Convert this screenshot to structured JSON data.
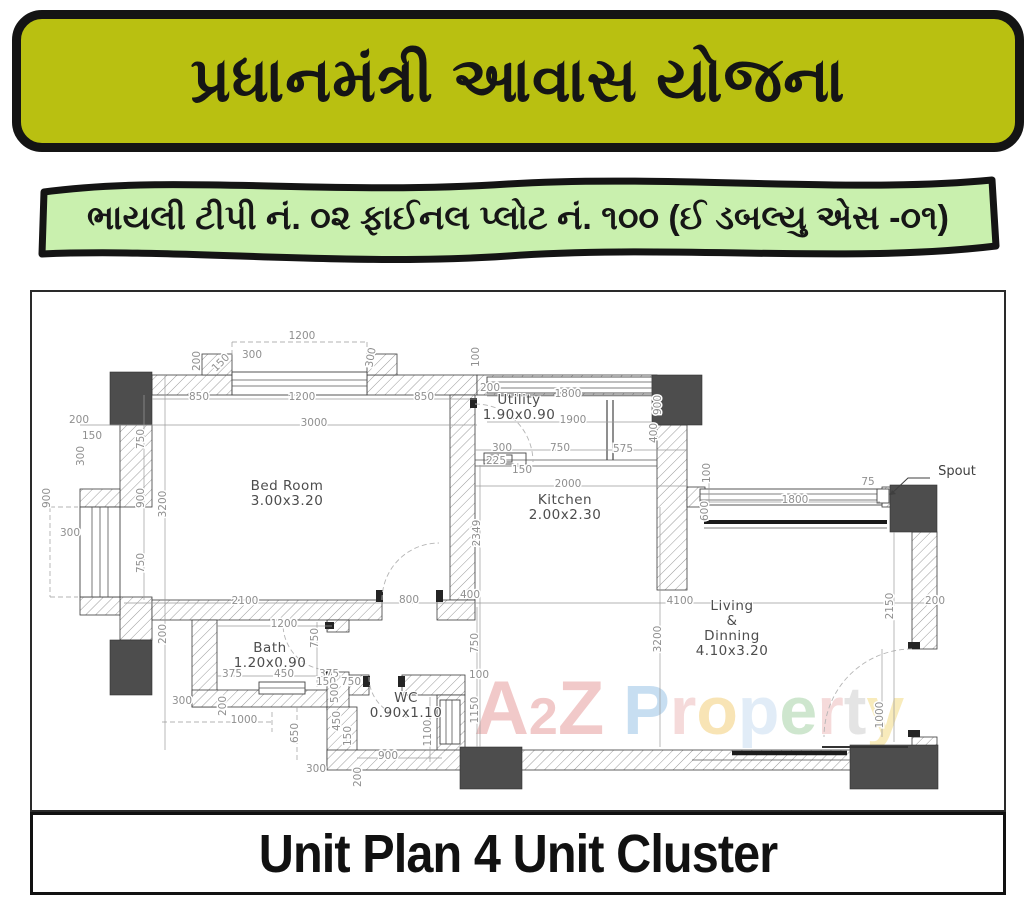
{
  "header": {
    "title": "પ્રધાનમંત્રી આવાસ યોજના"
  },
  "subheader": {
    "text": "ભાયલી ટીપી નં. ૦૨ ફાઈનલ પ્લોટ નં. ૧૦૦ (ઈ ડબલ્યુ એસ -૦૧)"
  },
  "footer": {
    "title": "Unit Plan 4 Unit Cluster"
  },
  "colors": {
    "banner1_bg": "#b9c011",
    "banner1_border": "#141414",
    "banner2_bg": "#c9f0ae",
    "ink": "#111111",
    "dim_text": "#8f8f8f",
    "wall_stroke": "#3a3a3a",
    "column_fill": "#4d4d4d"
  },
  "watermark": {
    "text": "A2Z Property",
    "letters": [
      {
        "ch": "A",
        "color": "#e07f7f",
        "size": 76
      },
      {
        "ch": "2",
        "color": "#e07f7f",
        "size": 52
      },
      {
        "ch": "Z",
        "color": "#e07f7f",
        "size": 76
      },
      {
        "ch": " ",
        "color": "#ffffff",
        "size": 68
      },
      {
        "ch": "P",
        "color": "#7bb3e0",
        "size": 70
      },
      {
        "ch": "r",
        "color": "#e8a8a8",
        "size": 68
      },
      {
        "ch": "o",
        "color": "#f0c050",
        "size": 68
      },
      {
        "ch": "p",
        "color": "#b8d4ee",
        "size": 68
      },
      {
        "ch": "e",
        "color": "#8cc68c",
        "size": 68
      },
      {
        "ch": "r",
        "color": "#e8a8a8",
        "size": 68
      },
      {
        "ch": "t",
        "color": "#c0c0c0",
        "size": 68
      },
      {
        "ch": "y",
        "color": "#f0d060",
        "size": 68
      }
    ]
  },
  "plan": {
    "annotations": {
      "spout": {
        "text": "Spout"
      }
    },
    "rooms": [
      {
        "x": 255,
        "y": 198,
        "lines": [
          "Bed Room",
          "3.00x3.20"
        ]
      },
      {
        "x": 487,
        "y": 112,
        "lines": [
          "Utility",
          "1.90x0.90"
        ]
      },
      {
        "x": 533,
        "y": 212,
        "lines": [
          "Kitchen",
          "2.00x2.30"
        ]
      },
      {
        "x": 238,
        "y": 360,
        "lines": [
          "Bath",
          "1.20x0.90"
        ]
      },
      {
        "x": 374,
        "y": 410,
        "lines": [
          "WC",
          "0.90x1.10"
        ]
      },
      {
        "x": 700,
        "y": 318,
        "lines": [
          "Living",
          "&",
          "Dinning",
          "4.10x3.20"
        ]
      }
    ],
    "dimensions": [
      {
        "x": 270,
        "y": 47,
        "t": "1200"
      },
      {
        "x": 168,
        "y": 69,
        "t": "200",
        "r": -90
      },
      {
        "x": 191,
        "y": 73,
        "t": "150",
        "r": -45
      },
      {
        "x": 220,
        "y": 66,
        "t": "300"
      },
      {
        "x": 342,
        "y": 66,
        "t": "300",
        "r": -80
      },
      {
        "x": 167,
        "y": 108,
        "t": "850"
      },
      {
        "x": 270,
        "y": 108,
        "t": "1200"
      },
      {
        "x": 392,
        "y": 108,
        "t": "850"
      },
      {
        "x": 282,
        "y": 134,
        "t": "3000"
      },
      {
        "x": 47,
        "y": 131,
        "t": "200"
      },
      {
        "x": 60,
        "y": 147,
        "t": "150"
      },
      {
        "x": 52,
        "y": 164,
        "t": "300",
        "r": -90
      },
      {
        "x": 18,
        "y": 206,
        "t": "900",
        "r": -90
      },
      {
        "x": 38,
        "y": 244,
        "t": "300"
      },
      {
        "x": 112,
        "y": 147,
        "t": "750",
        "r": -90
      },
      {
        "x": 112,
        "y": 206,
        "t": "900",
        "r": -90
      },
      {
        "x": 112,
        "y": 271,
        "t": "750",
        "r": -90
      },
      {
        "x": 134,
        "y": 212,
        "t": "3200",
        "r": -90
      },
      {
        "x": 134,
        "y": 342,
        "t": "200",
        "r": -90
      },
      {
        "x": 447,
        "y": 65,
        "t": "100",
        "r": -90
      },
      {
        "x": 458,
        "y": 99,
        "t": "200"
      },
      {
        "x": 536,
        "y": 105,
        "t": "1800"
      },
      {
        "x": 541,
        "y": 131,
        "t": "1900"
      },
      {
        "x": 629,
        "y": 113,
        "t": "900",
        "r": -90
      },
      {
        "x": 625,
        "y": 141,
        "t": "400",
        "r": -90
      },
      {
        "x": 470,
        "y": 159,
        "t": "300"
      },
      {
        "x": 464,
        "y": 172,
        "t": "225"
      },
      {
        "x": 528,
        "y": 159,
        "t": "750"
      },
      {
        "x": 591,
        "y": 160,
        "t": "575"
      },
      {
        "x": 490,
        "y": 181,
        "t": "150"
      },
      {
        "x": 536,
        "y": 195,
        "t": "2000"
      },
      {
        "x": 448,
        "y": 241,
        "t": "2349",
        "r": -90
      },
      {
        "x": 836,
        "y": 193,
        "t": "75"
      },
      {
        "x": 763,
        "y": 211,
        "t": "1800"
      },
      {
        "x": 678,
        "y": 181,
        "t": "100",
        "r": -90
      },
      {
        "x": 676,
        "y": 219,
        "t": "600",
        "r": -90
      },
      {
        "x": 861,
        "y": 314,
        "t": "2150",
        "r": -90
      },
      {
        "x": 903,
        "y": 312,
        "t": "200"
      },
      {
        "x": 648,
        "y": 312,
        "t": "4100"
      },
      {
        "x": 629,
        "y": 347,
        "t": "3200",
        "r": -90
      },
      {
        "x": 851,
        "y": 423,
        "t": "1000",
        "r": -90
      },
      {
        "x": 213,
        "y": 312,
        "t": "2100"
      },
      {
        "x": 377,
        "y": 311,
        "t": "800"
      },
      {
        "x": 438,
        "y": 306,
        "t": "400"
      },
      {
        "x": 446,
        "y": 351,
        "t": "750",
        "r": -90
      },
      {
        "x": 447,
        "y": 386,
        "t": "100"
      },
      {
        "x": 446,
        "y": 418,
        "t": "1150",
        "r": -90
      },
      {
        "x": 252,
        "y": 335,
        "t": "1200"
      },
      {
        "x": 286,
        "y": 346,
        "t": "750",
        "r": -90
      },
      {
        "x": 200,
        "y": 385,
        "t": "375"
      },
      {
        "x": 252,
        "y": 385,
        "t": "450"
      },
      {
        "x": 297,
        "y": 385,
        "t": "375"
      },
      {
        "x": 150,
        "y": 412,
        "t": "300"
      },
      {
        "x": 194,
        "y": 414,
        "t": "200",
        "r": -90
      },
      {
        "x": 212,
        "y": 431,
        "t": "1000"
      },
      {
        "x": 266,
        "y": 441,
        "t": "650",
        "r": -90
      },
      {
        "x": 284,
        "y": 480,
        "t": "300"
      },
      {
        "x": 294,
        "y": 393,
        "t": "150"
      },
      {
        "x": 319,
        "y": 393,
        "t": "750"
      },
      {
        "x": 306,
        "y": 401,
        "t": "500",
        "r": -90
      },
      {
        "x": 308,
        "y": 429,
        "t": "450",
        "r": -90
      },
      {
        "x": 319,
        "y": 444,
        "t": "150",
        "r": -90
      },
      {
        "x": 356,
        "y": 467,
        "t": "900"
      },
      {
        "x": 399,
        "y": 441,
        "t": "1100",
        "r": -90
      },
      {
        "x": 329,
        "y": 485,
        "t": "200",
        "r": -90
      }
    ]
  }
}
